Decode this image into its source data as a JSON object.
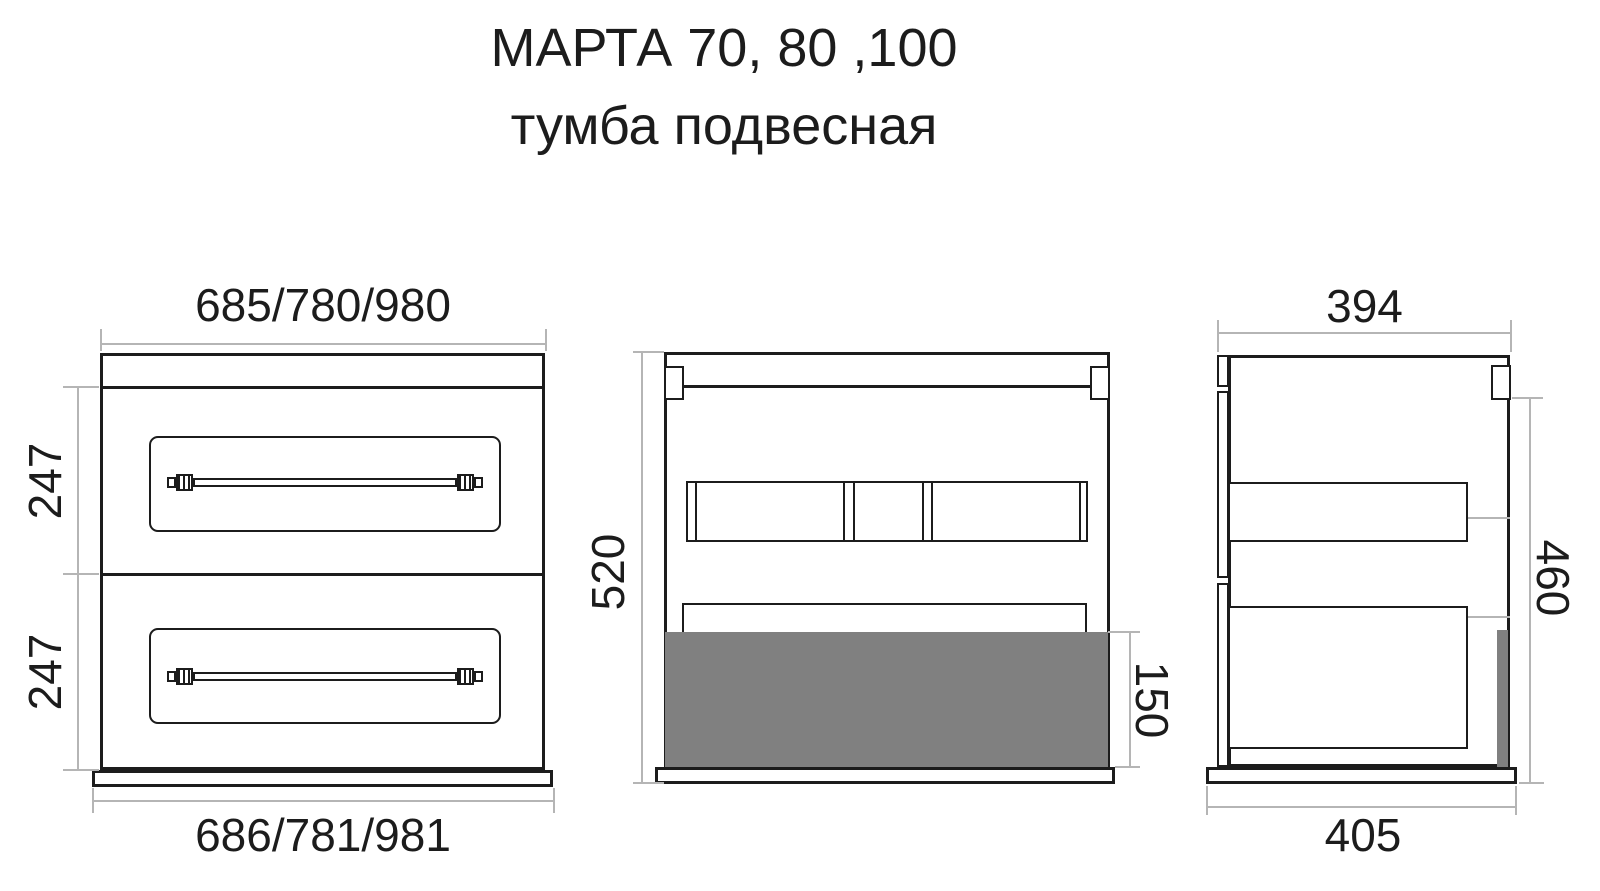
{
  "title": {
    "line1": "МАРТА 70, 80 ,100",
    "line2": "тумба подвесная"
  },
  "views": {
    "front": {
      "dim_width_top": "685/780/980",
      "dim_width_bottom": "686/781/981",
      "dim_drawer1_height": "247",
      "dim_drawer2_height": "247"
    },
    "section": {
      "dim_total_height": "520",
      "dim_bottom_panel_height": "150"
    },
    "side": {
      "dim_depth_top": "394",
      "dim_depth_bottom": "405",
      "dim_hanging_height": "460"
    }
  },
  "colors": {
    "line": "#1c1c1c",
    "dim_line": "#b5b5b5",
    "panel_fill": "#808080",
    "background": "#ffffff"
  }
}
